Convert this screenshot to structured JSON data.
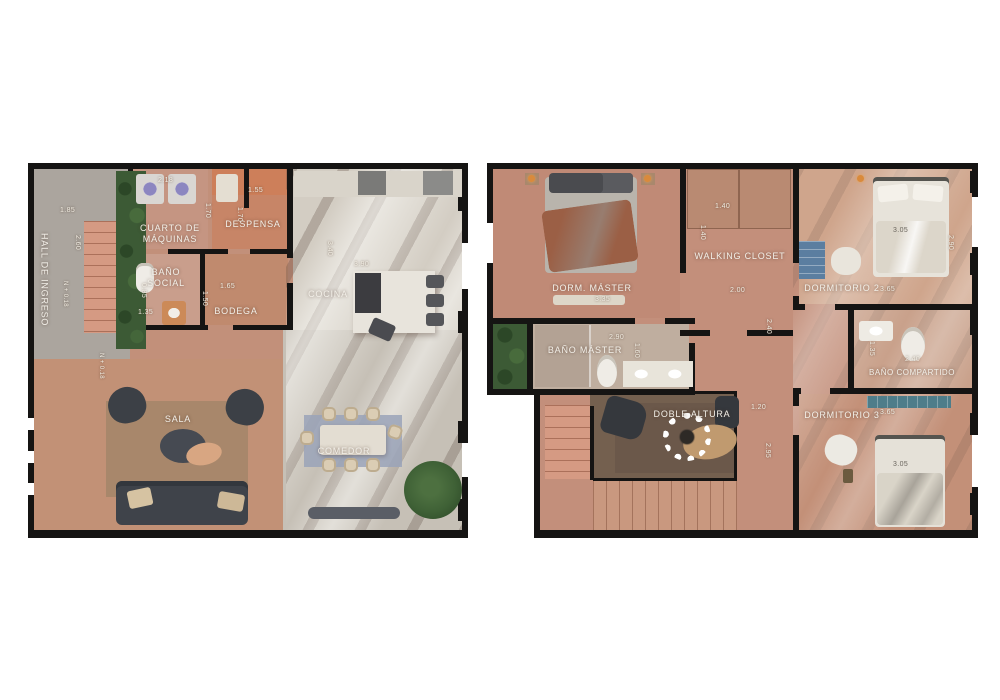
{
  "palette": {
    "background": "#ffffff",
    "wall": "#151413",
    "wood_floor": "#c2907a",
    "wood_floor_right": "#c38f7b",
    "concrete_floor": "#c6c0b6",
    "hall_concrete": "#aba59e",
    "kitchen_light": "#d3cdc3",
    "stairs_salmon": "#d59a83",
    "hedge_green": "#3c5a35",
    "dining_rug_blue": "#9aa3b8",
    "sala_rug_brown": "#a8876b",
    "void_dark_wood": "#74604f",
    "closet_blue": "#5b7ea0",
    "accent_orange": "#d98a3c",
    "label_text": "#f2efe8"
  },
  "left": {
    "name": "planta-baja-floor-plan",
    "rooms": {
      "hall": "HALL DE INGRESO",
      "cuarto_maquinas": "CUARTO DE MÁQUINAS",
      "despensa": "DESPENSA",
      "bano_social": "BAÑO SOCIAL",
      "bodega": "BODEGA",
      "cocina": "COCINA",
      "sala": "SALA",
      "comedor": "COMEDOR"
    },
    "dims": {
      "hall_w": "1.85",
      "hall_stairs": "2.60",
      "maquinas_w": "2.18",
      "despensa_h1": "1.70",
      "despensa_h2": "1.70",
      "despensa_w": "1.55",
      "bano_w": "1.35",
      "bano_h": "0.85",
      "bodega_w": "1.65",
      "bodega_h": "1.50",
      "cocina_h": "3.40",
      "cocina_w": "3.90",
      "level_hall": "N + 0.18",
      "level_sala": "N + 0.18"
    }
  },
  "right": {
    "name": "planta-alta-floor-plan",
    "rooms": {
      "dorm_master": "DORM. MÁSTER",
      "walking_closet": "WALKING CLOSET",
      "dormitorio2": "DORMITORIO 2",
      "bano_master": "BAÑO MÁSTER",
      "bano_compartido": "BAÑO COMPARTIDO",
      "doble_altura": "DOBLE ALTURA",
      "dormitorio3": "DORMITORIO 3"
    },
    "dims": {
      "master_w": "3.35",
      "closet_w": "1.40",
      "closet_h": "1.40",
      "d2_bed": "3.05",
      "d2_h": "2.90",
      "d2_w": "3.65",
      "hall_w": "2.00",
      "hall_h": "2.40",
      "bm_w": "2.90",
      "bm_h": "1.60",
      "bc_w": "2.40",
      "bc_h": "1.35",
      "void_w": "1.20",
      "void_h": "2.95",
      "d3_w": "3.65",
      "d3_bed": "3.05"
    }
  }
}
